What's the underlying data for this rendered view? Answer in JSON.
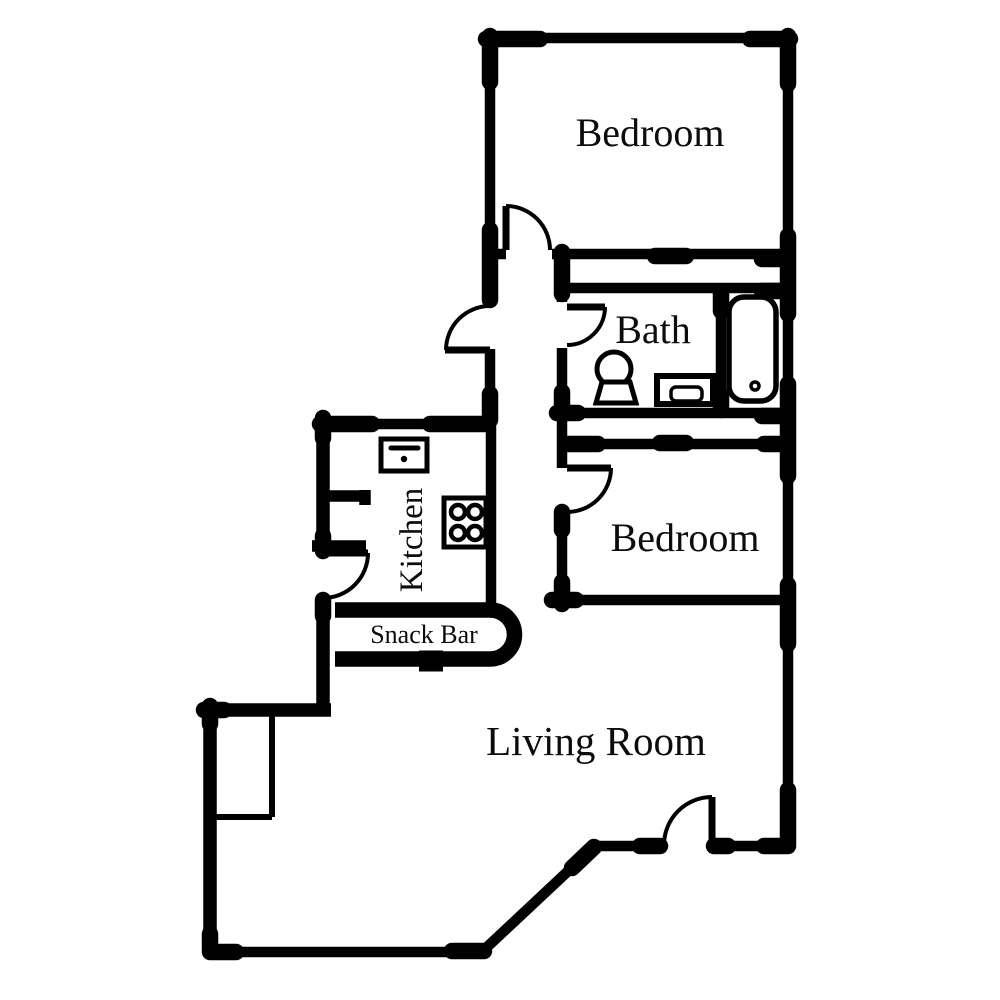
{
  "colors": {
    "ink": "#000000",
    "background": "#ffffff"
  },
  "rooms": {
    "bedroom1": {
      "label": "Bedroom"
    },
    "bath": {
      "label": "Bath"
    },
    "bedroom2": {
      "label": "Bedroom"
    },
    "kitchen": {
      "label": "Kitchen"
    },
    "snack_bar": {
      "label": "Snack Bar"
    },
    "living_room": {
      "label": "Living Room"
    }
  },
  "fixtures": {
    "bathtub": "bathtub",
    "toilet": "toilet",
    "pedestal_sink": "pedestal sink",
    "kitchen_sink": "kitchen sink",
    "stove": "stove with 4 burners"
  }
}
